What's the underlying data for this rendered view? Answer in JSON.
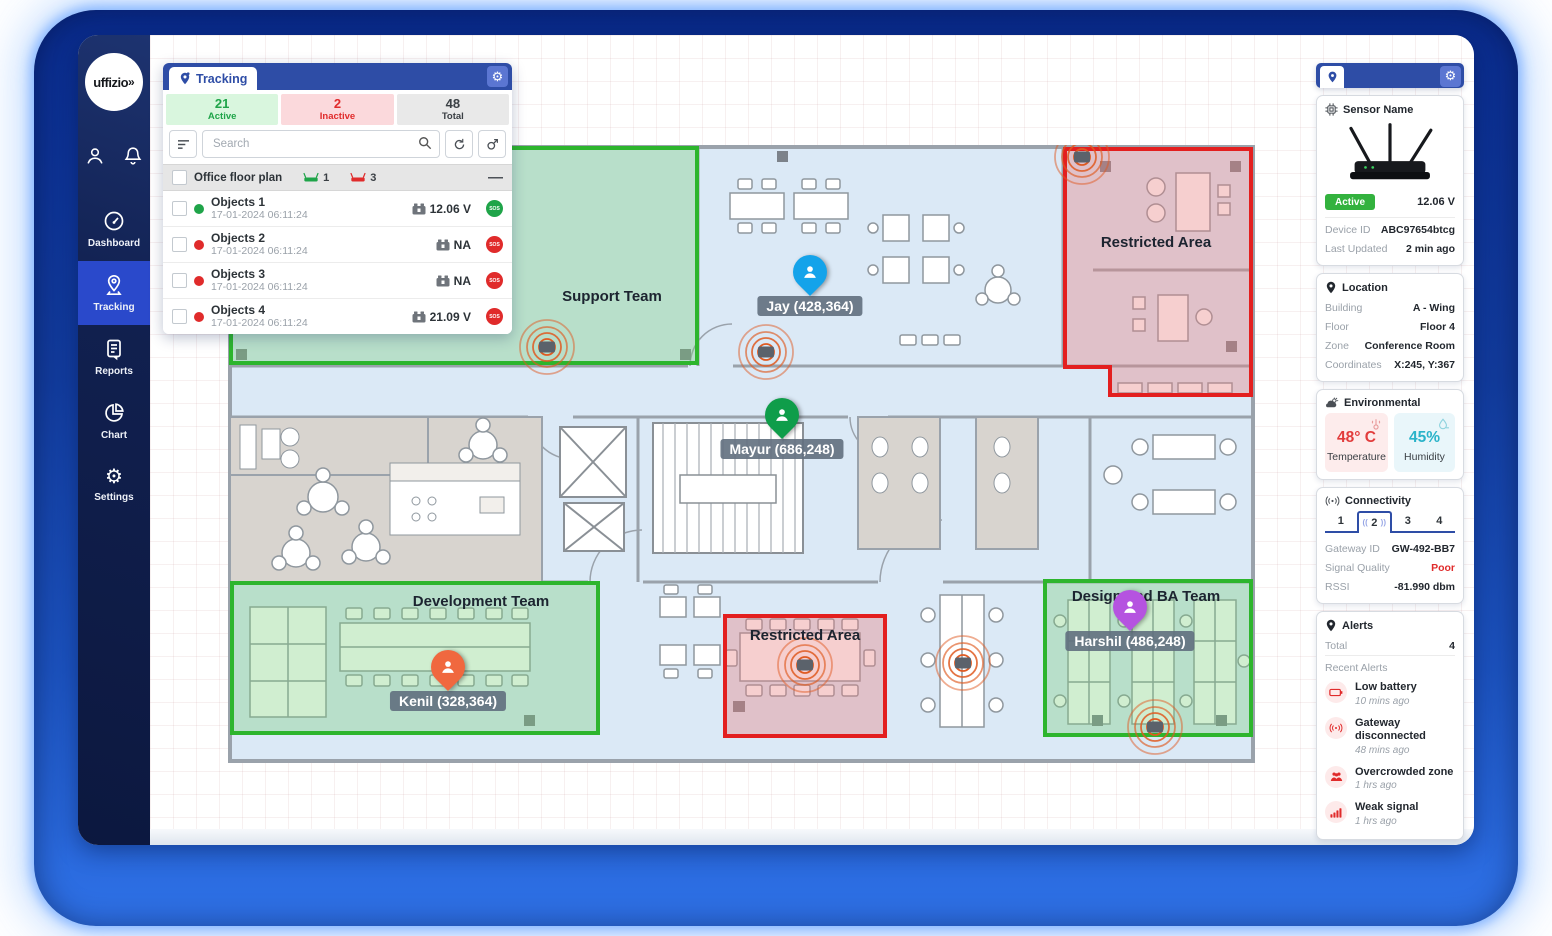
{
  "app": {
    "brand": "uffizio"
  },
  "colors": {
    "accent_blue": "#2e4da6",
    "sidebar_navy": "#0c183f",
    "active_green": "#1fa449",
    "alert_red": "#e02b2b",
    "zone_green": "#2db52d",
    "zone_red": "#e31f1f",
    "sensor_orange": "#df5a21"
  },
  "sidebar": {
    "items": [
      {
        "label": "Dashboard",
        "icon": "dashboard-icon",
        "active": false
      },
      {
        "label": "Tracking",
        "icon": "tracking-icon",
        "active": true
      },
      {
        "label": "Reports",
        "icon": "reports-icon",
        "active": false
      },
      {
        "label": "Chart",
        "icon": "chart-icon",
        "active": false
      },
      {
        "label": "Settings",
        "icon": "settings-icon",
        "active": false
      }
    ]
  },
  "tracking_panel": {
    "title": "Tracking",
    "stats": [
      {
        "value": "21",
        "label": "Active"
      },
      {
        "value": "2",
        "label": "Inactive"
      },
      {
        "value": "48",
        "label": "Total"
      }
    ],
    "search_placeholder": "Search",
    "group": {
      "name": "Office floor plan",
      "active_count": "1",
      "inactive_count": "3",
      "collapse": "—"
    },
    "sos_label": "SOS",
    "objects": [
      {
        "name": "Objects 1",
        "timestamp": "17-01-2024 06:11:24",
        "battery": "12.06 V",
        "status": "active"
      },
      {
        "name": "Objects 2",
        "timestamp": "17-01-2024 06:11:24",
        "battery": "NA",
        "status": "inactive"
      },
      {
        "name": "Objects 3",
        "timestamp": "17-01-2024 06:11:24",
        "battery": "NA",
        "status": "inactive"
      },
      {
        "name": "Objects 4",
        "timestamp": "17-01-2024 06:11:24",
        "battery": "21.09 V",
        "status": "inactive"
      }
    ]
  },
  "floorplan": {
    "zones": [
      {
        "name": "Support Team",
        "type": "green"
      },
      {
        "name": "Development Team",
        "type": "green"
      },
      {
        "name": "Design and BA Team",
        "type": "green"
      },
      {
        "name": "Restricted Area",
        "type": "red"
      },
      {
        "name": "Restricted Area",
        "type": "red"
      }
    ],
    "people": [
      {
        "name": "Jay",
        "label": "Jay (428,364)",
        "color": "#14a3ea"
      },
      {
        "name": "Mayur",
        "label": "Mayur (686,248)",
        "color": "#0f9d4a"
      },
      {
        "name": "Kenil",
        "label": "Kenil (328,364)",
        "color": "#f0683f"
      },
      {
        "name": "Harshil",
        "label": "Harshil (486,248)",
        "color": "#b553e0"
      }
    ]
  },
  "sensor_panel": {
    "sensor": {
      "title": "Sensor Name",
      "status": "Active",
      "voltage": "12.06 V",
      "device_id_label": "Device ID",
      "device_id": "ABC97654btcg",
      "last_updated_label": "Last Updated",
      "last_updated": "2 min ago"
    },
    "location": {
      "title": "Location",
      "rows": [
        {
          "label": "Building",
          "value": "A - Wing"
        },
        {
          "label": "Floor",
          "value": "Floor 4"
        },
        {
          "label": "Zone",
          "value": "Conference Room"
        },
        {
          "label": "Coordinates",
          "value": "X:245, Y:367"
        }
      ]
    },
    "environmental": {
      "title": "Environmental",
      "temperature_value": "48° C",
      "temperature_label": "Temperature",
      "humidity_value": "45%",
      "humidity_label": "Humidity"
    },
    "connectivity": {
      "title": "Connectivity",
      "tabs": [
        "1",
        "2",
        "3",
        "4"
      ],
      "active_tab": "2",
      "rows": [
        {
          "label": "Gateway ID",
          "value": "GW-492-BB7"
        },
        {
          "label": "Signal Quality",
          "value": "Poor"
        },
        {
          "label": "RSSI",
          "value": "-81.990 dbm"
        }
      ]
    },
    "alerts": {
      "title": "Alerts",
      "total_label": "Total",
      "total": "4",
      "recent_label": "Recent Alerts",
      "items": [
        {
          "title": "Low battery",
          "time": "10 mins ago",
          "icon": "battery-icon"
        },
        {
          "title": "Gateway disconnected",
          "time": "48 mins ago",
          "icon": "antenna-icon"
        },
        {
          "title": "Overcrowded zone",
          "time": "1 hrs ago",
          "icon": "people-icon"
        },
        {
          "title": "Weak signal",
          "time": "1 hrs ago",
          "icon": "signal-icon"
        }
      ]
    }
  }
}
